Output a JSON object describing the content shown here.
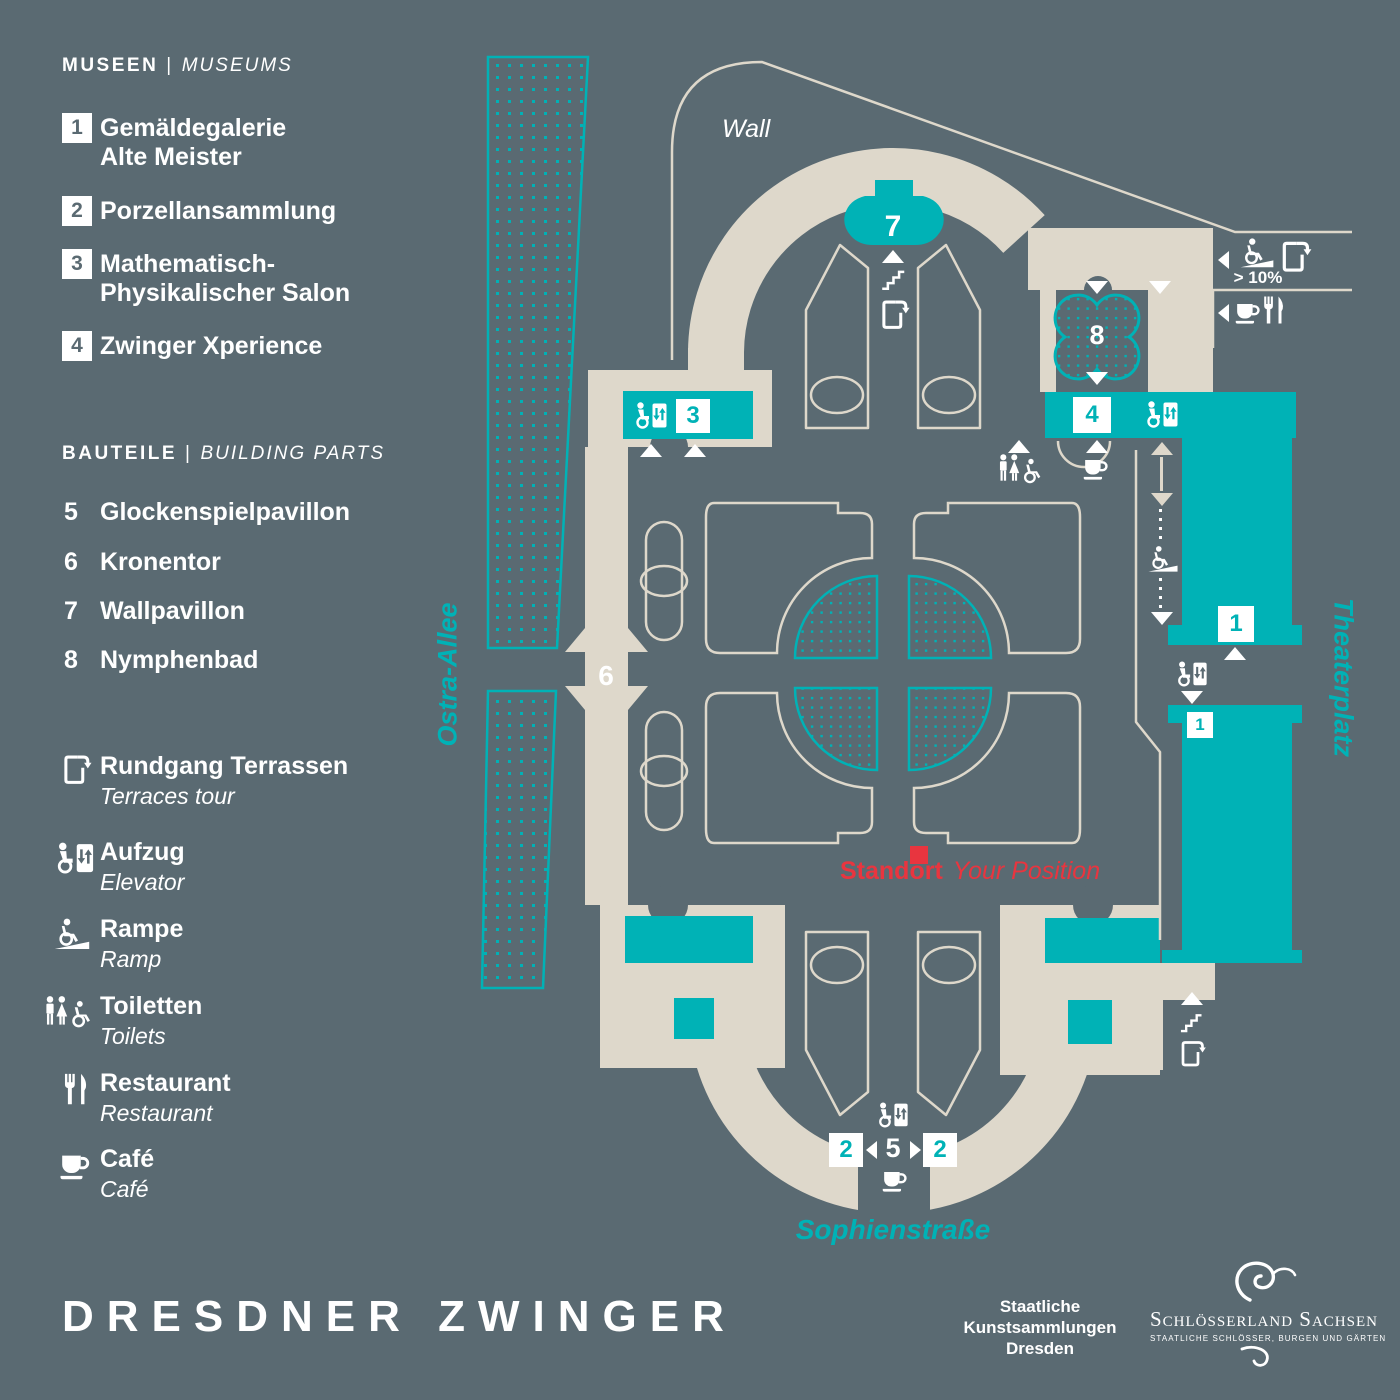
{
  "colors": {
    "background": "#5a6a72",
    "path_cream": "#ded8cb",
    "accent_teal": "#00b2b6",
    "white": "#ffffff",
    "marker_red": "#e8353f"
  },
  "legend": {
    "sep": "|",
    "museums": {
      "title_de": "MUSEEN",
      "title_en": "MUSEUMS",
      "items": [
        {
          "num": "1",
          "line1": "Gemäldegalerie",
          "line2": "Alte Meister"
        },
        {
          "num": "2",
          "line1": "Porzellansammlung",
          "line2": ""
        },
        {
          "num": "3",
          "line1": "Mathematisch-",
          "line2": "Physikalischer Salon"
        },
        {
          "num": "4",
          "line1": "Zwinger Xperience",
          "line2": ""
        }
      ]
    },
    "building_parts": {
      "title_de": "BAUTEILE",
      "title_en": "BUILDING PARTS",
      "items": [
        {
          "num": "5",
          "label": "Glockenspielpavillon"
        },
        {
          "num": "6",
          "label": "Kronentor"
        },
        {
          "num": "7",
          "label": "Wallpavillon"
        },
        {
          "num": "8",
          "label": "Nymphenbad"
        }
      ]
    },
    "facilities": [
      {
        "icon": "terraces-tour-icon",
        "de": "Rundgang Terrassen",
        "en": "Terraces tour"
      },
      {
        "icon": "elevator-icon",
        "de": "Aufzug",
        "en": "Elevator"
      },
      {
        "icon": "ramp-icon",
        "de": "Rampe",
        "en": "Ramp"
      },
      {
        "icon": "toilets-icon",
        "de": "Toiletten",
        "en": "Toilets"
      },
      {
        "icon": "restaurant-icon",
        "de": "Restaurant",
        "en": "Restaurant"
      },
      {
        "icon": "cafe-icon",
        "de": "Café",
        "en": "Café"
      }
    ]
  },
  "map": {
    "labels": {
      "wall": "Wall",
      "ostra_allee": "Ostra-Allee",
      "theaterplatz": "Theaterplatz",
      "sophienstrasse": "Sophienstraße",
      "ramp_grade": "> 10%"
    },
    "position": {
      "de": "Standort",
      "en": "Your Position"
    },
    "markers": {
      "wallpavillon": "7",
      "nymphenbad": "8",
      "zwinger_xperience": "4",
      "math_salon": "3",
      "gemaeldegalerie_upper": "1",
      "gemaeldegalerie_lower": "1",
      "kronentor": "6",
      "glockenspielpavillon": "5",
      "porzellan_left": "2",
      "porzellan_right": "2"
    }
  },
  "title": "DRESDNER ZWINGER",
  "footer": {
    "skd_lines": [
      "Staatliche",
      "Kunstsammlungen",
      "Dresden"
    ],
    "schloesserland": {
      "name": "Schlösserland Sachsen",
      "subtitle": "STAATLICHE SCHLÖSSER, BURGEN UND GÄRTEN"
    }
  }
}
